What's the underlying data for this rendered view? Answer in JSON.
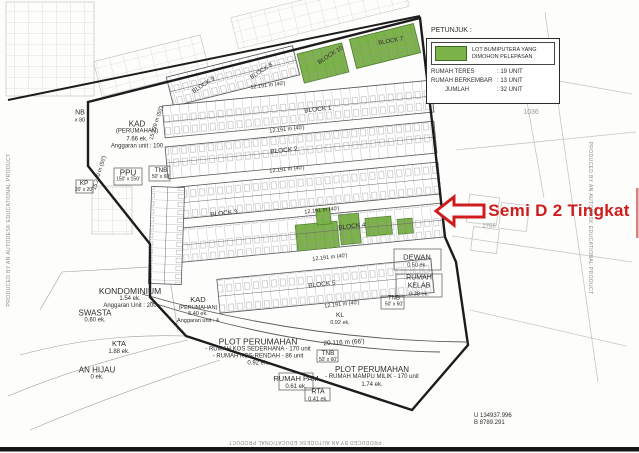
{
  "watermark": "PRODUCED BY AN AUTODESK EDUCATIONAL PRODUCT",
  "annotation": {
    "label": "Semi D 2 Tingkat"
  },
  "legend": {
    "title": "PETUNJUK :",
    "swatch_label_line1": "LOT BUMIPUTERA YANG",
    "swatch_label_line2": "DIMOHON PELEPASAN",
    "swatch_color": "#7cb24a",
    "rows": [
      {
        "label": "RUMAH TERES",
        "value": ": 19 UNIT"
      },
      {
        "label": "RUMAH BERKEMBAR",
        "value": ": 13 UNIT"
      },
      {
        "label": "JUMLAH",
        "value": ": 32 UNIT"
      }
    ]
  },
  "blocks": {
    "b1": "BLOCK 1",
    "b2": "BLOCK 2",
    "b3": "BLOCK 3",
    "b4": "BLOCK 4",
    "b5": "BLOCK 5",
    "b7": "BLOCK 7",
    "b8": "BLOCK 8",
    "b9": "BLOCK 9",
    "b10": "BLOCK 10"
  },
  "dims": {
    "d40": "12.191 m (40')",
    "d66": "20.116 m (66')",
    "d50a": "15.239 m (50')",
    "d50b": "15.240 m (50')"
  },
  "areas": {
    "nb": {
      "l1": "NB",
      "l2": "x 80"
    },
    "kad1": {
      "l1": "KAD",
      "l2": "(PERUMAHAN)",
      "l3": "7.66 ek.",
      "l4": "Anggaran unit : 100"
    },
    "ppu": {
      "l1": "PPU",
      "l2": "150' x 150'"
    },
    "tnb1": {
      "l1": "TNB",
      "l2": "50' x 60'"
    },
    "kp": {
      "l1": "KP",
      "l2": "20' x 20'"
    },
    "kondominium": {
      "l1": "KONDOMINIUM",
      "l2": "1.54 ek.",
      "l3": "Anggaran Unit : 200"
    },
    "swasta": {
      "l1": "SWASTA",
      "l2": "0.60 ek."
    },
    "kta": {
      "l1": "KTA",
      "l2": "1.88 ek."
    },
    "hijau": {
      "l1": "AN HIJAU",
      "l2": "0 ek."
    },
    "kad2": {
      "l1": "KAD",
      "l2": "(PERUMAHAN)",
      "l3": "5.40 ek.",
      "l4": "Anggaran unit : 4"
    },
    "plot1": {
      "l1": "PLOT PERUMAHAN",
      "l2": "- RUMAH KOS SEDERHANA - 170 unit",
      "l3": "- RUMAH KOS-RENDAH - 86 unit",
      "l4": "0.92 ek."
    },
    "plot2": {
      "l1": "PLOT PERUMAHAN",
      "l2": "- RUMAH MAMPU MILIK - 170 unit",
      "l3": "1.74 ek."
    },
    "rumah_pam": {
      "l1": "RUMAH PAM",
      "l2": "0.61 ek."
    },
    "tnb2": {
      "l1": "TNB",
      "l2": "50' x 60'"
    },
    "rta": {
      "l1": "RTA",
      "l2": "0.41 ek."
    },
    "dewan": {
      "l1": "DEWAN",
      "l2": "0.50 ek."
    },
    "rumah_kelab": {
      "l1": "RUMAH",
      "l2": "KELAB",
      "l3": "0.38 ek."
    },
    "tnb3": {
      "l1": "TNB",
      "l2": "50' x 60'"
    },
    "kl": {
      "l1": "KL",
      "l2": "0.92 ek."
    }
  },
  "coords": {
    "l1": "U 134937.996",
    "l2": "B 8789.291"
  },
  "parcels": {
    "p1": "1036",
    "p2": "2766"
  },
  "colors": {
    "green": "#7cb24a",
    "red": "#cf1d1d"
  }
}
